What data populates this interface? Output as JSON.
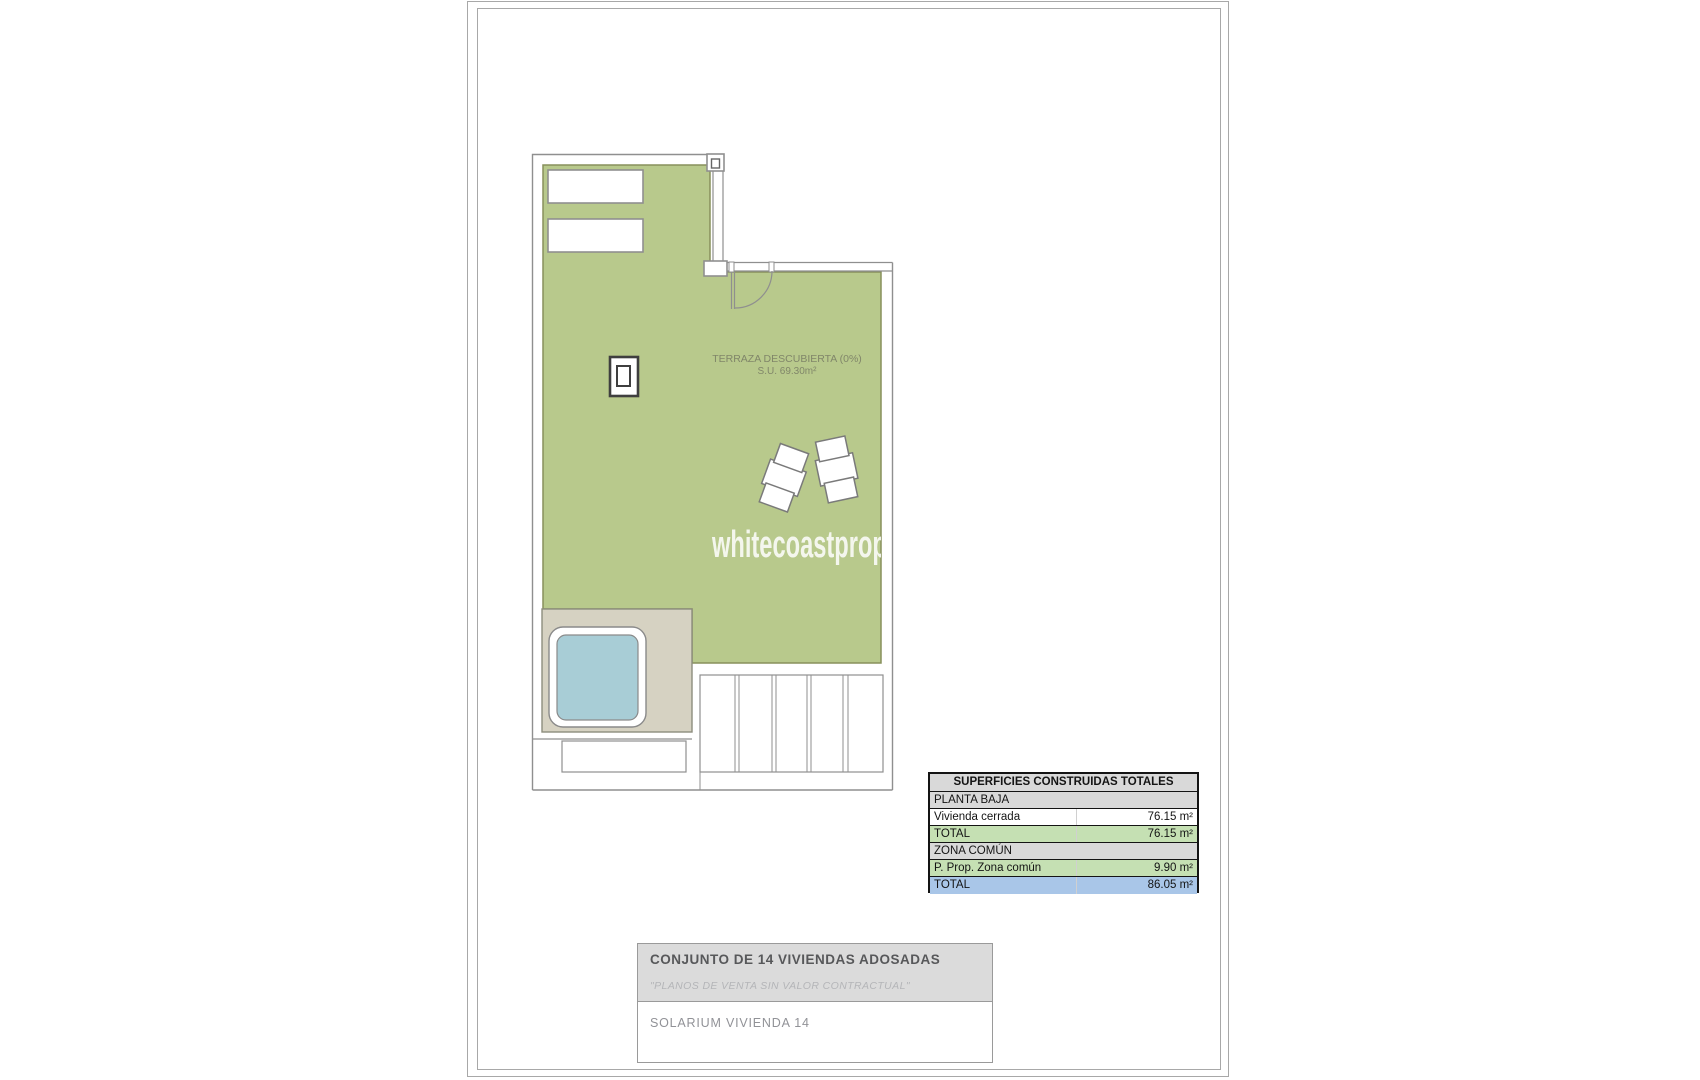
{
  "plan": {
    "terrace_label": "TERRAZA DESCUBIERTA (0%)",
    "terrace_area": "S.U. 69.30m²",
    "watermark": "whitecoastproperties",
    "colors": {
      "terrace_green": "#b8c98c",
      "terrace_border": "#87905c",
      "deck_beige": "#d6d2c2",
      "pool_blue": "#a8cdd6",
      "wall_gray": "#8f8f8f"
    }
  },
  "area_table": {
    "header": "SUPERFICIES CONSTRUIDAS TOTALES",
    "rows": [
      {
        "label": "PLANTA BAJA",
        "value": ""
      },
      {
        "label": "Vivienda cerrada",
        "value": "76.15 m²"
      },
      {
        "label": "TOTAL",
        "value": "76.15 m²"
      },
      {
        "label": "ZONA COMÚN",
        "value": ""
      },
      {
        "label": "P. Prop. Zona común",
        "value": "9.90 m²"
      },
      {
        "label": "TOTAL",
        "value": "86.05 m²"
      }
    ],
    "colors": {
      "section_bg": "#d9d9d9",
      "subtotal_bg": "#c5e0b3",
      "grandtotal_bg": "#a9c6e8"
    }
  },
  "title_block": {
    "project_title": "CONJUNTO DE 14 VIVIENDAS ADOSADAS",
    "disclaimer": "\"PLANOS DE VENTA SIN VALOR CONTRACTUAL\"",
    "drawing_title": "SOLARIUM VIVIENDA 14"
  }
}
